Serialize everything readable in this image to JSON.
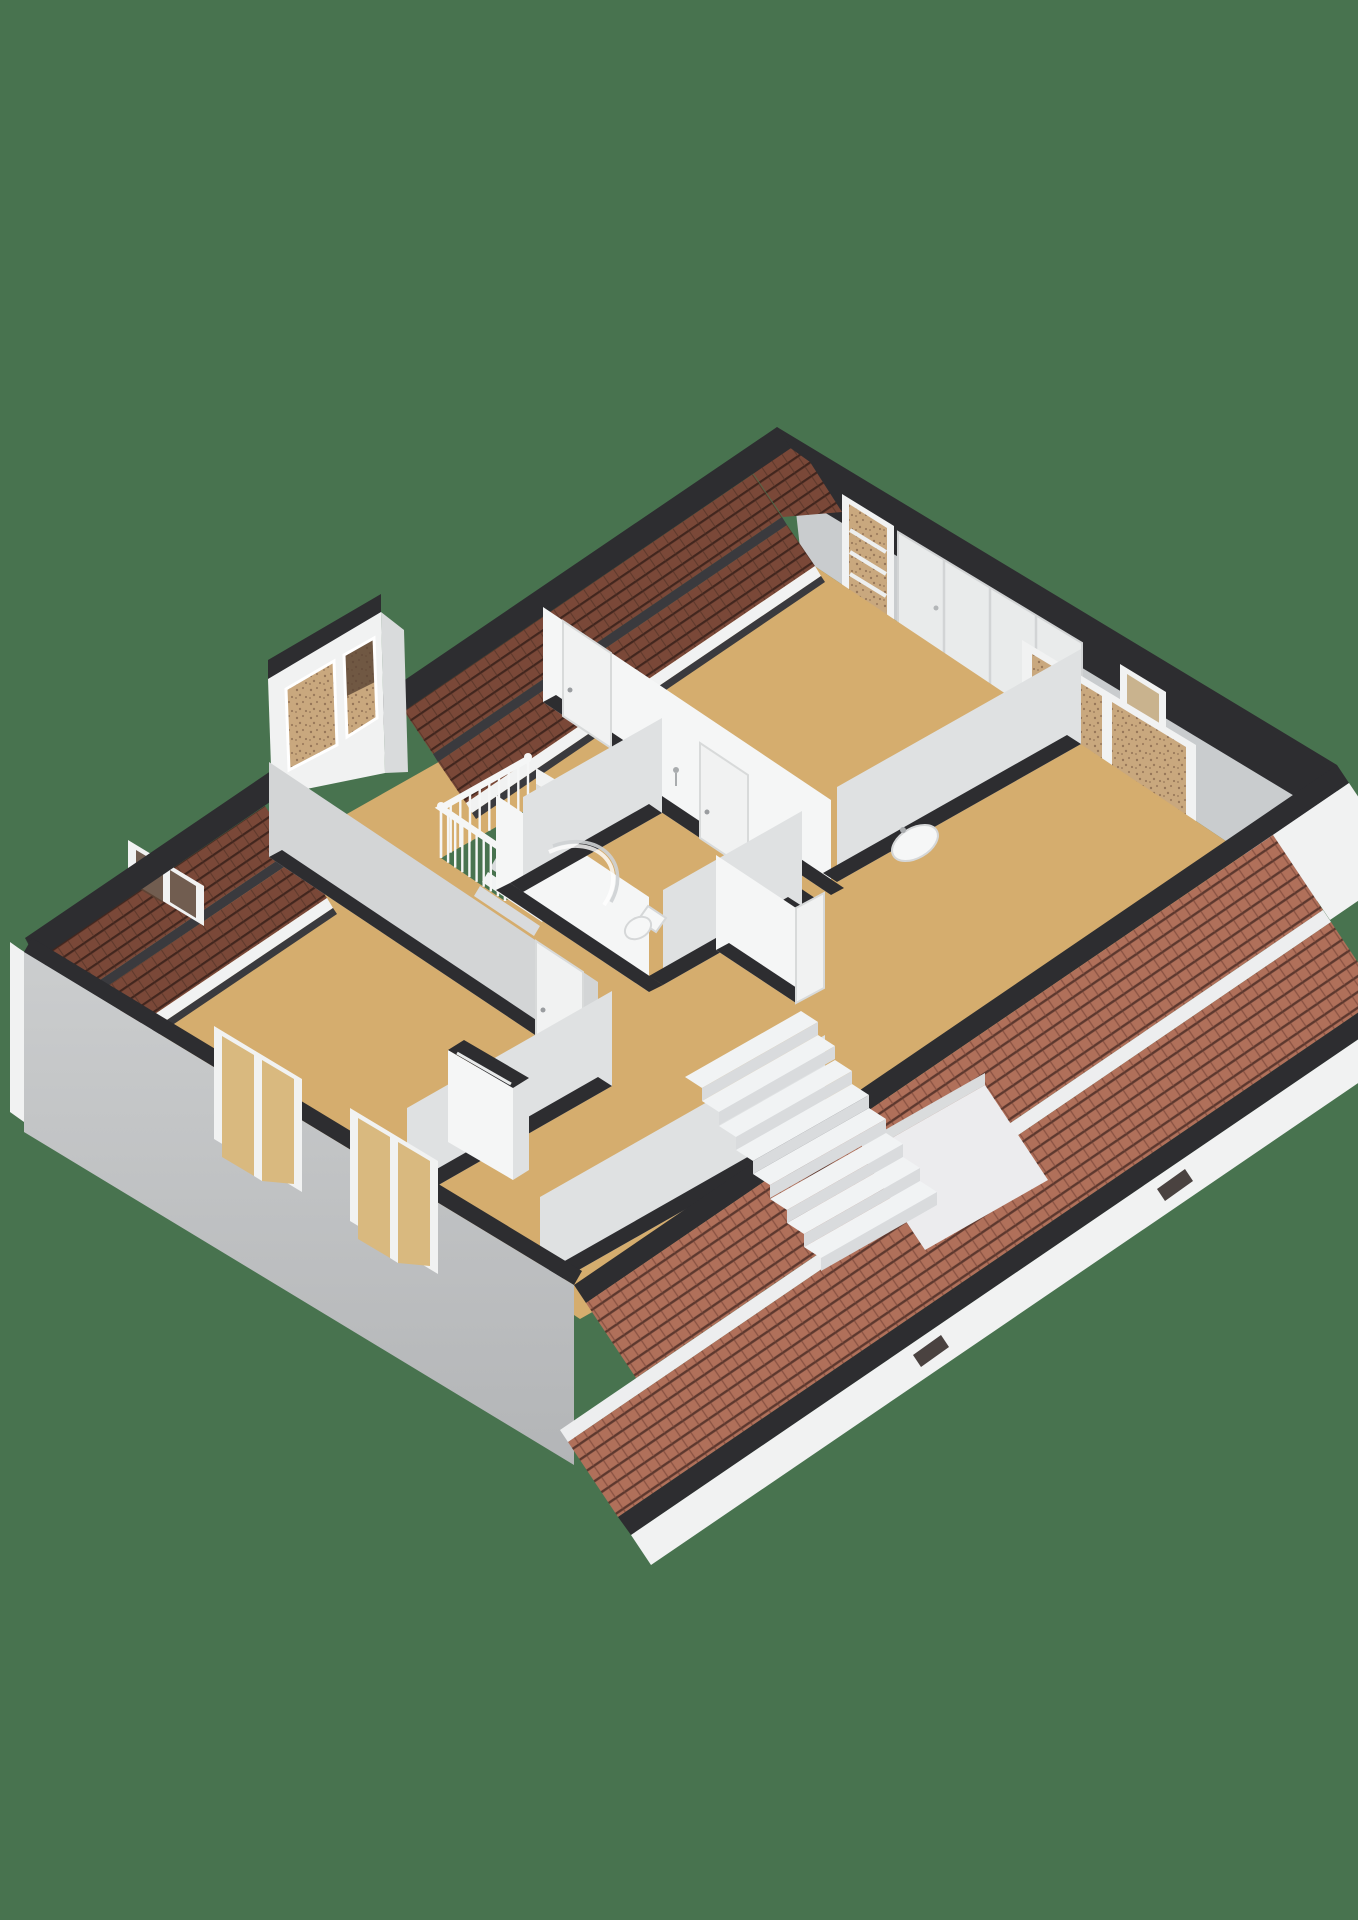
{
  "scene": {
    "type": "isometric-3d-floorplan-render",
    "floor_shown": "upper floor cutaway",
    "rooms_visible": 6,
    "dormer_window_panes": 2,
    "facade_windows": 2,
    "ne_wall_features": [
      "tall-french-window",
      "wardrobe-panels",
      "interior-door",
      "double-window"
    ],
    "main_staircase_steps": 8,
    "upper_staircase_steps": 6,
    "balustrade_rail_runs": 4,
    "fascia_windows": 2,
    "fixtures": [
      "sink",
      "shower",
      "toilet",
      "chimney-duct"
    ]
  },
  "colors": {
    "bg": "#48734F",
    "floor": "#D5AD6E",
    "capDark": "#2D2D30",
    "capSoft": "#3A3A3E",
    "wallWhite": "#F5F6F6",
    "wallLight": "#DFE1E2",
    "wallGray": "#C9CCCE",
    "wallMid": "#D3D5D6",
    "fascia": "#F1F2F2",
    "gutter": "#EDEEEF",
    "tileExt": "#B0705A",
    "tileExtLine": "#5D382E",
    "tileExtTick": "#8A5343",
    "tileInt": "#7A4838",
    "tileIntLine": "#42261E",
    "tileIntTick": "#5F392C",
    "glassTan": "#C9A87E",
    "glassSpeck": "#6B4C38",
    "glassDark": "#5A4334",
    "glassFacade": "#D9B97F",
    "stairTop": "#F1F3F4",
    "stairRiser": "#D9DBDD",
    "rail": "#F5F6F6",
    "fixture": "#F6F7F7",
    "fixtureLine": "#D5D7D8",
    "metal": "#A9ACAE"
  }
}
